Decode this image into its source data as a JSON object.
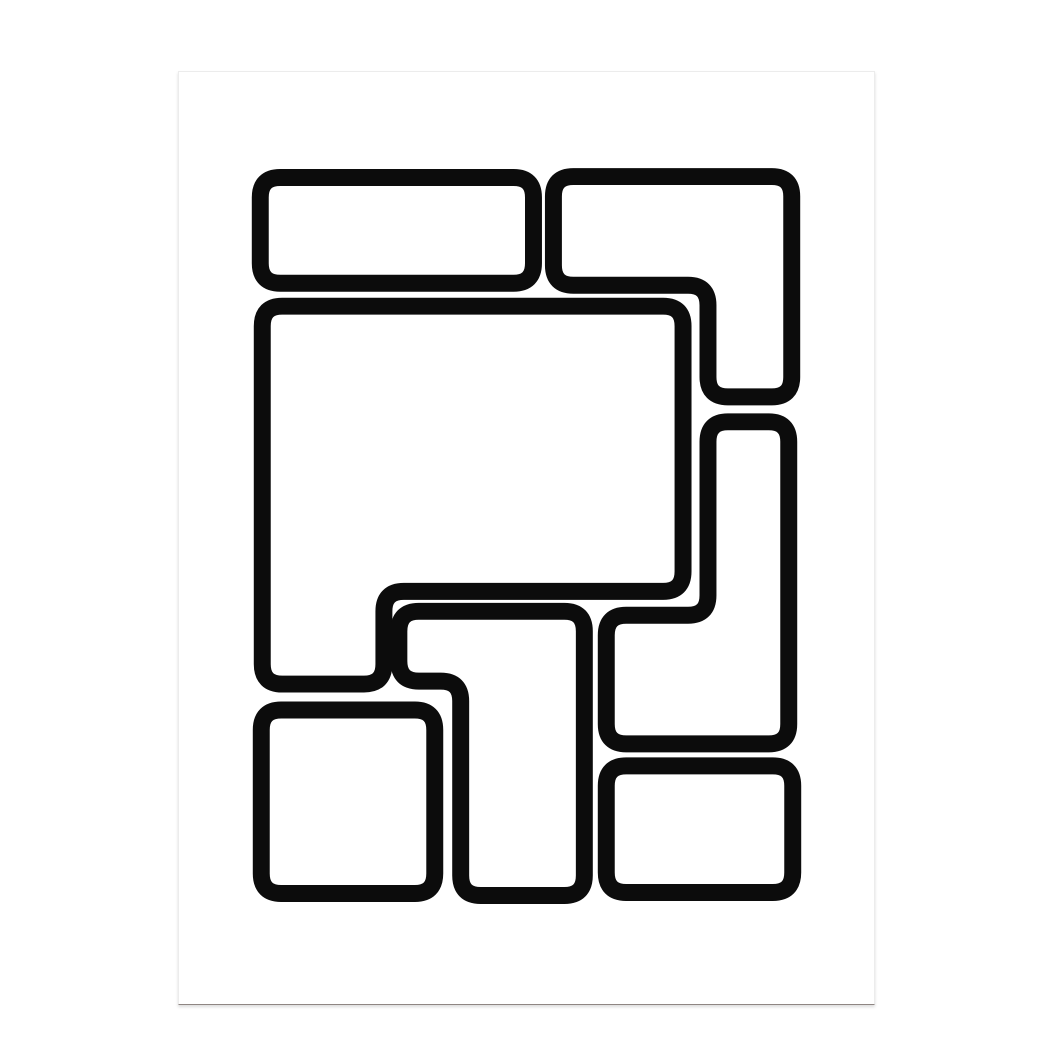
{
  "page": {
    "background_color": "#ffffff"
  },
  "poster": {
    "x": 178,
    "y": 71,
    "width": 697,
    "height": 934,
    "background_color": "#ffffff",
    "edge_color": "#ececec",
    "bottom_edge_color": "#8f8683",
    "shadow_color": "rgba(0,0,0,0.14)"
  },
  "artwork": {
    "ink_color": "#0c0c0c",
    "fill_color": "#ffffff",
    "stroke_width": 17,
    "corner_radius": 20,
    "shapes": [
      {
        "name": "top-left-rounded-rectangle",
        "points": [
          [
            259.5,
            176.5
          ],
          [
            533.5,
            176.5
          ],
          [
            533.5,
            282.5
          ],
          [
            259.5,
            282.5
          ]
        ]
      },
      {
        "name": "top-right-l-shape",
        "points": [
          [
            553.5,
            175.5
          ],
          [
            792.5,
            175.5
          ],
          [
            792.5,
            396.5
          ],
          [
            708.5,
            396.5
          ],
          [
            708.5,
            284.5
          ],
          [
            553.5,
            284.5
          ]
        ]
      },
      {
        "name": "center-large-notched-rectangle",
        "points": [
          [
            261.5,
            305.5
          ],
          [
            683.5,
            305.5
          ],
          [
            683.5,
            591.5
          ],
          [
            383.5,
            591.5
          ],
          [
            383.5,
            684.5
          ],
          [
            261.5,
            684.5
          ]
        ]
      },
      {
        "name": "right-j-shape",
        "points": [
          [
            708.5,
            421.5
          ],
          [
            789.5,
            421.5
          ],
          [
            789.5,
            744.5
          ],
          [
            606.5,
            744.5
          ],
          [
            606.5,
            615.5
          ],
          [
            708.5,
            615.5
          ]
        ]
      },
      {
        "name": "bottom-left-rounded-square",
        "points": [
          [
            260.5,
            710.5
          ],
          [
            434.5,
            710.5
          ],
          [
            434.5,
            894.5
          ],
          [
            260.5,
            894.5
          ]
        ]
      },
      {
        "name": "bottom-middle-l-shape",
        "points": [
          [
            398.5,
            611.5
          ],
          [
            584.5,
            611.5
          ],
          [
            584.5,
            896.5
          ],
          [
            460.5,
            896.5
          ],
          [
            460.5,
            681.5
          ],
          [
            398.5,
            681.5
          ]
        ]
      },
      {
        "name": "bottom-right-rounded-rectangle",
        "points": [
          [
            606.5,
            766.5
          ],
          [
            793.5,
            766.5
          ],
          [
            793.5,
            893.5
          ],
          [
            606.5,
            893.5
          ]
        ]
      }
    ]
  }
}
